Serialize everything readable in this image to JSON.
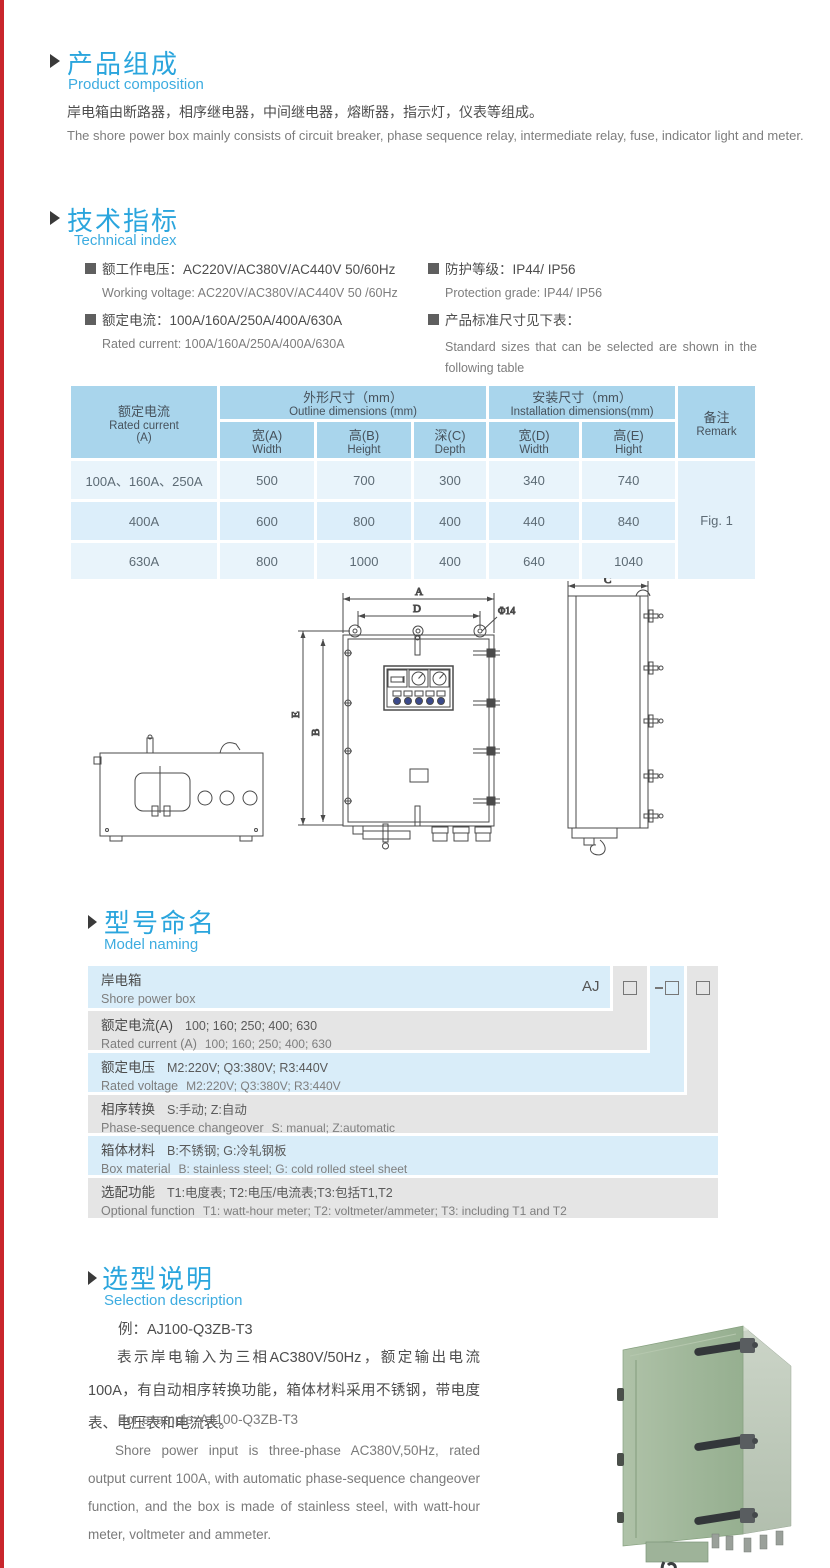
{
  "composition": {
    "title_zh": "产品组成",
    "title_en": "Product  composition",
    "body_zh": "岸电箱由断路器，相序继电器，中间继电器，熔断器，指示灯，仪表等组成。",
    "body_en": "The shore power box mainly consists of circuit breaker, phase sequence relay, intermediate relay, fuse, indicator light and meter."
  },
  "technical": {
    "title_zh": "技术指标",
    "title_en": "Technical index",
    "specs": [
      {
        "zh": "额工作电压：AC220V/AC380V/AC440V  50/60Hz",
        "en": "Working voltage: AC220V/AC380V/AC440V 50 /60Hz"
      },
      {
        "zh": "额定电流：100A/160A/250A/400A/630A",
        "en": "Rated current: 100A/160A/250A/400A/630A"
      },
      {
        "zh": "防护等级：IP44/ IP56",
        "en": "Protection grade: IP44/ IP56"
      },
      {
        "zh": "产品标准尺寸见下表：",
        "en": "Standard sizes that can be selected are shown in the following table"
      }
    ]
  },
  "dim_table": {
    "header": {
      "current_zh": "额定电流",
      "current_en": "Rated current",
      "current_unit": "(A)",
      "outline_zh": "外形尺寸（mm）",
      "outline_en": "Outline dimensions (mm)",
      "install_zh": "安装尺寸（mm）",
      "install_en": "Installation dimensions(mm)",
      "remark_zh": "备注",
      "remark_en": "Remark",
      "sub": [
        {
          "zh": "宽(A)",
          "en": "Width"
        },
        {
          "zh": "高(B)",
          "en": "Height"
        },
        {
          "zh": "深(C)",
          "en": "Depth"
        },
        {
          "zh": "宽(D)",
          "en": "Width"
        },
        {
          "zh": "高(E)",
          "en": "Hight"
        }
      ]
    },
    "rows": [
      {
        "current": "100A、160A、250A",
        "w": "500",
        "h": "700",
        "d": "300",
        "iw": "340",
        "ih": "740"
      },
      {
        "current": "400A",
        "w": "600",
        "h": "800",
        "d": "400",
        "iw": "440",
        "ih": "840"
      },
      {
        "current": "630A",
        "w": "800",
        "h": "1000",
        "d": "400",
        "iw": "640",
        "ih": "1040"
      }
    ],
    "remark_value": "Fig. 1"
  },
  "drawing": {
    "labels": {
      "a": "A",
      "d": "D",
      "dia": "Φ14",
      "e": "E",
      "b": "B",
      "c": "C"
    }
  },
  "model_naming": {
    "title_zh": "型号命名",
    "title_en": "Model naming",
    "prefix": "AJ",
    "codes": [
      "□",
      "-□",
      "□"
    ],
    "rows": [
      {
        "zh": "岸电箱",
        "zh_value": "",
        "en": "Shore power box",
        "en_value": ""
      },
      {
        "zh": "额定电流(A)",
        "zh_value": "100; 160; 250; 400; 630",
        "en": "Rated current (A)",
        "en_value": "100; 160; 250; 400; 630"
      },
      {
        "zh": "额定电压",
        "zh_value": "M2:220V;  Q3:380V;  R3:440V",
        "en": "Rated voltage",
        "en_value": "M2:220V;  Q3:380V;  R3:440V"
      },
      {
        "zh": "相序转换",
        "zh_value": "S:手动; Z:自动",
        "en": "Phase-sequence changeover",
        "en_value": "S: manual;  Z:automatic"
      },
      {
        "zh": "箱体材料",
        "zh_value": "B:不锈钢;  G:冷轧钢板",
        "en": "Box material",
        "en_value": "B: stainless steel; G: cold rolled steel sheet"
      },
      {
        "zh": "选配功能",
        "zh_value": "T1:电度表;  T2:电压/电流表;T3:包括T1,T2",
        "en": "Optional function",
        "en_value": "T1: watt-hour meter; T2: voltmeter/ammeter; T3: including T1 and T2"
      }
    ]
  },
  "selection": {
    "title_zh": "选型说明",
    "title_en": "Selection description",
    "example_zh": "例：AJ100-Q3ZB-T3",
    "para_zh": "表示岸电输入为三相AC380V/50Hz，额定输出电流100A，有自动相序转换功能，箱体材料采用不锈钢，带电度表、电压表和电流表。",
    "example_en": "For example: AJ100-Q3ZB-T3",
    "para_en": "Shore power input is three-phase AC380V,50Hz, rated output current 100A, with automatic phase-sequence changeover function, and the box is made of stainless steel, with watt-hour meter, voltmeter and ammeter."
  },
  "colors": {
    "accent_blue": "#2aa5dd",
    "table_header": "#a9d5ec",
    "row_blue": "#d9edf9",
    "row_gray": "#e5e5e5",
    "photo_green": "#a4bb9e"
  }
}
